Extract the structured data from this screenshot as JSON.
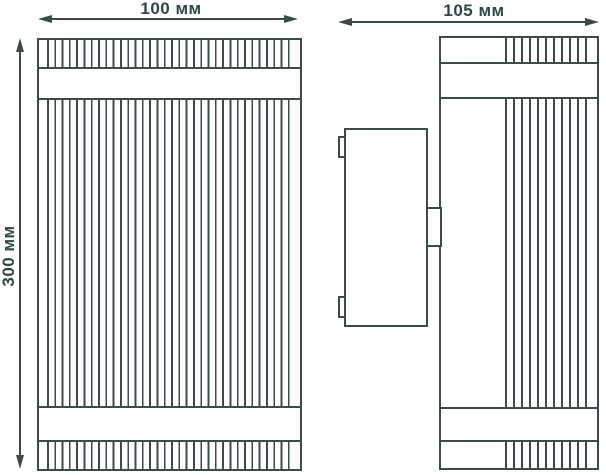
{
  "drawing": {
    "description": "Technical dimension drawing of a ribbed wall luminaire: front view and side view with wall-mounting bracket",
    "views": {
      "front": "front-view",
      "side": "side-view"
    },
    "dimensions": {
      "front_width": "100 мм",
      "front_height": "300 мм",
      "side_depth": "105 мм"
    },
    "colors": {
      "line": "#3c4b47",
      "text": "#2d4946",
      "background": "#ffffff"
    }
  }
}
